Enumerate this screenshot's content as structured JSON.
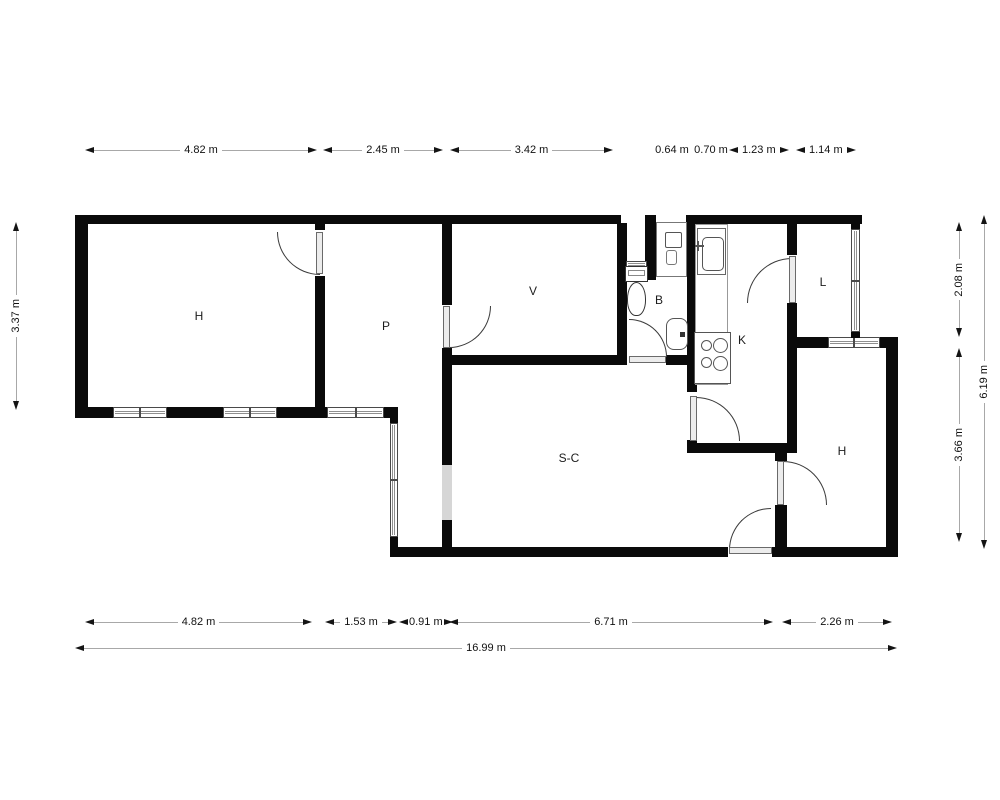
{
  "rooms": {
    "h_left": "H",
    "p": "P",
    "v": "V",
    "b": "B",
    "k": "K",
    "l": "L",
    "sc": "S-C",
    "h_right": "H"
  },
  "dimensions": {
    "top": [
      "4.82 m",
      "2.45 m",
      "3.42 m",
      "0.64 m",
      "0.70 m",
      "1.23 m",
      "1.14 m"
    ],
    "bottom": [
      "4.82 m",
      "1.53 m",
      "0.91 m",
      "6.71 m",
      "2.26 m"
    ],
    "total_width": "16.99 m",
    "left": "3.37 m",
    "right_inner": [
      "2.08 m",
      "3.66 m"
    ],
    "right_total": "6.19 m"
  },
  "colors": {
    "wall": "#0a0a0a",
    "window_line": "#8f8f8f",
    "door_arc": "#3a3a3a",
    "wall_opening": "#d6d6d6",
    "dimension_line": "#a8a8a8",
    "text": "#111111",
    "background": "#ffffff"
  }
}
